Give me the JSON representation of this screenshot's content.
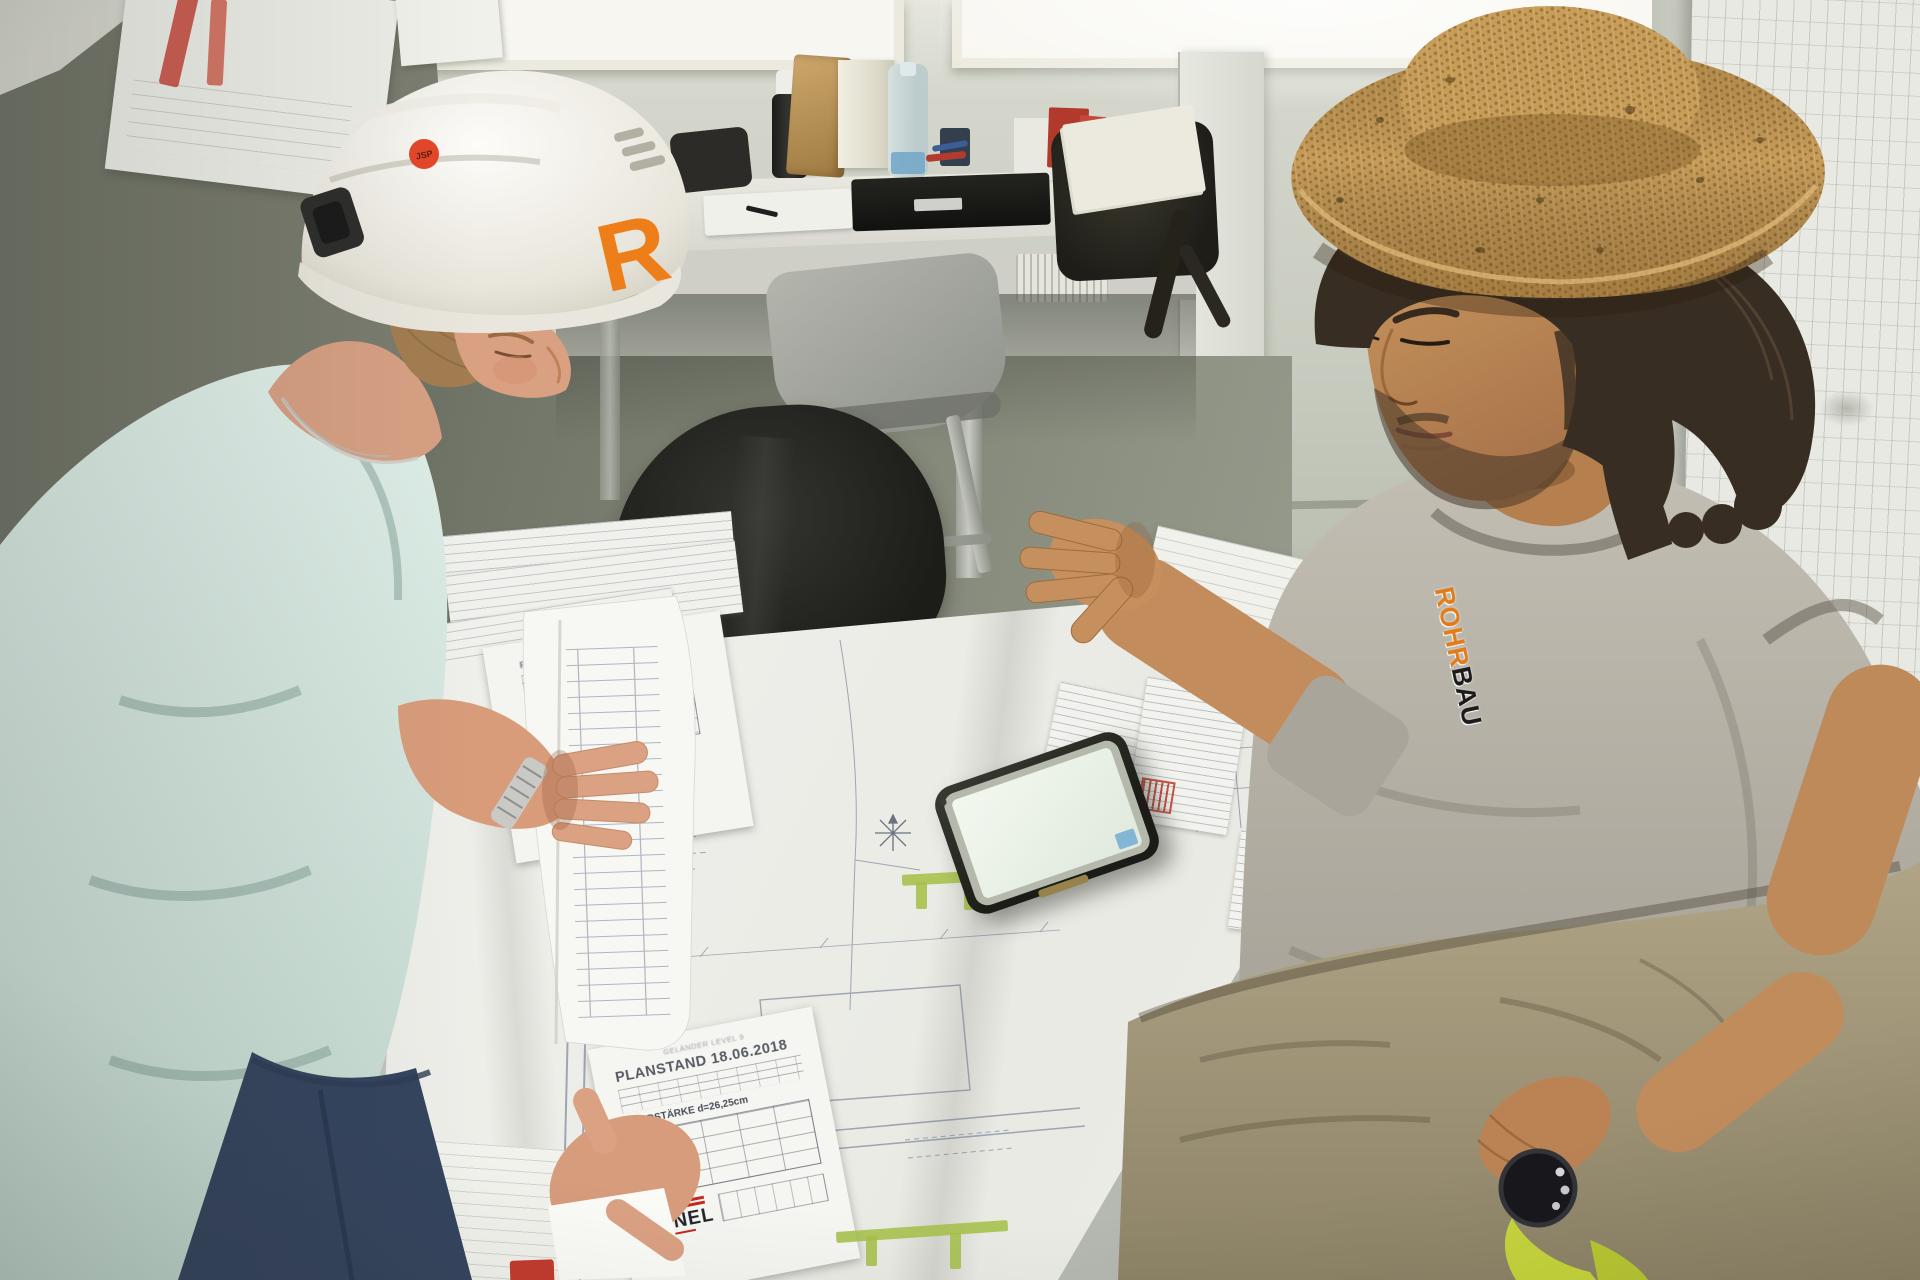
{
  "helmet": {
    "logo_letter": "R",
    "sticker_text": "JSP",
    "shell_color": "#f5f3ee",
    "logo_color": "#ee7e1a",
    "sticker_color": "#e4472a"
  },
  "shirt_logo": {
    "part1": "ROHR",
    "part2": "BAU",
    "part1_color": "#e07b1e",
    "part2_color": "#1b1b1b"
  },
  "plan_stamps": {
    "top": {
      "title": "PLANSTAND 14.06.2018",
      "brand": "HANEL",
      "brand_color": "#c03028"
    },
    "bottom": {
      "header": "GELÄNDER LEVEL 9",
      "title": "PLANSTAND 18.06.2018",
      "subtitle": "WANDSTÄRKE d=26,25cm",
      "brand": "HANEL",
      "brand_color": "#c5281f"
    }
  },
  "colors": {
    "left_wall": "#7e8173",
    "back_wall": "#c8cbbf",
    "right_wall": "#d8d9d0",
    "window_frame": "#eceade",
    "floor": "#7e8274",
    "desk": "#e0dfd8",
    "chair": "#a3a59d",
    "jacket": "#232320",
    "table_plans": "#f4f4f0",
    "plan_line": "#6b7690",
    "highlighter_green": "#a6bf4a",
    "phone_screen": "#e9f3e6",
    "phone_body": "#22221f",
    "shirt_left": "#d5e8e0",
    "jeans": "#35445e",
    "skin_left": "#d89c7b",
    "hat_straw": "#c79d5a",
    "hair_right": "#382d22",
    "skin_right": "#c08a5c",
    "shirt_right": "#b3aea3",
    "pants_right": "#a39878",
    "watch_strap_yellow": "#c6d53c",
    "hanel_red": "#c5281f",
    "sticker_red": "#c23a2e"
  }
}
